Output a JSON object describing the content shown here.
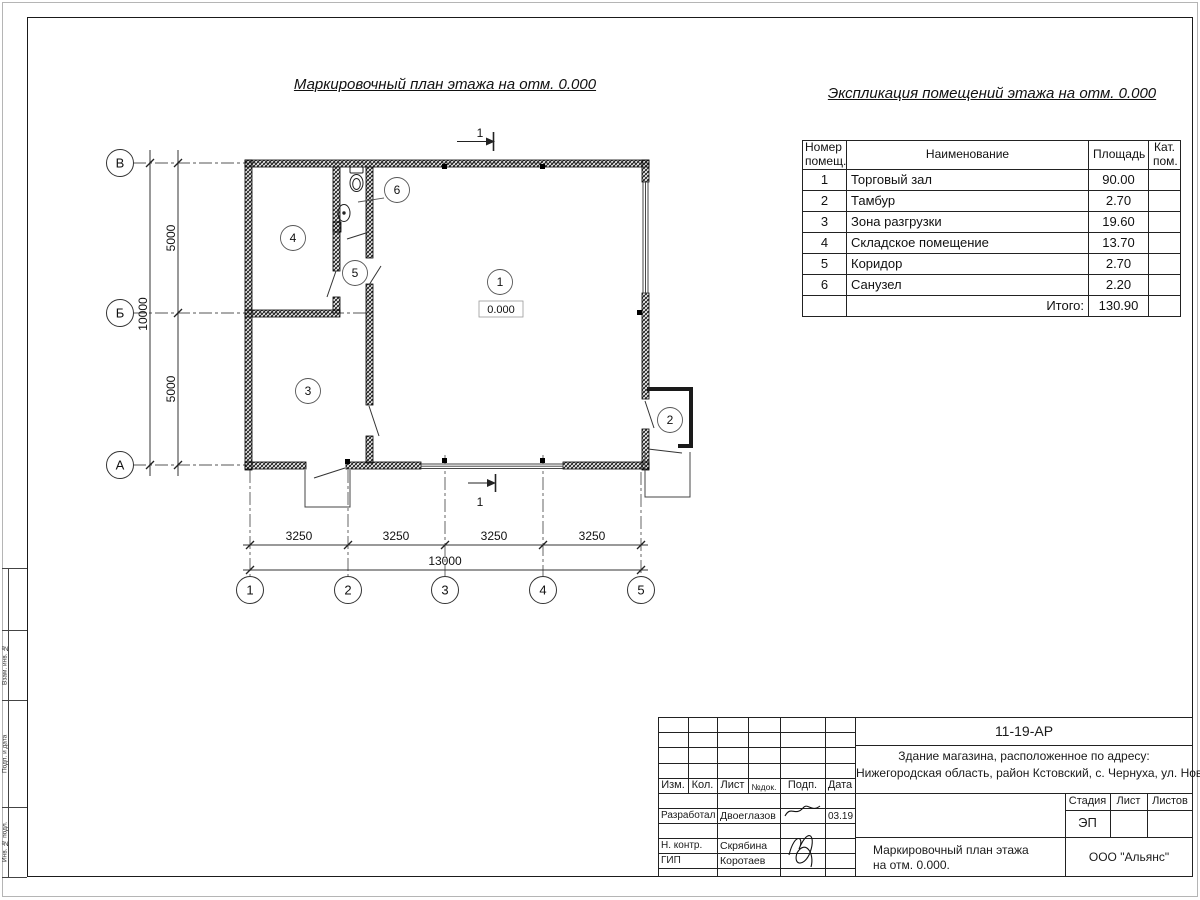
{
  "titles": {
    "plan": "Маркировочный план этажа на отм. 0.000",
    "explication": "Экспликация помещений этажа на отм. 0.000"
  },
  "explication_table": {
    "headers": {
      "number": "Номер помещ.",
      "name": "Наименование",
      "area": "Площадь",
      "category": "Кат. пом."
    },
    "rows": [
      {
        "n": "1",
        "name": "Торговый зал",
        "area": "90.00",
        "cat": ""
      },
      {
        "n": "2",
        "name": "Тамбур",
        "area": "2.70",
        "cat": ""
      },
      {
        "n": "3",
        "name": "Зона разгрузки",
        "area": "19.60",
        "cat": ""
      },
      {
        "n": "4",
        "name": "Складское помещение",
        "area": "13.70",
        "cat": ""
      },
      {
        "n": "5",
        "name": "Коридор",
        "area": "2.70",
        "cat": ""
      },
      {
        "n": "6",
        "name": "Санузел",
        "area": "2.20",
        "cat": ""
      }
    ],
    "total_label": "Итого:",
    "total_area": "130.90"
  },
  "plan": {
    "row_axes": [
      "В",
      "Б",
      "А"
    ],
    "col_axes": [
      "1",
      "2",
      "3",
      "4",
      "5"
    ],
    "dims": {
      "left_upper": "5000",
      "left_lower": "5000",
      "left_total": "10000",
      "bottom_1": "3250",
      "bottom_2": "3250",
      "bottom_3": "3250",
      "bottom_4": "3250",
      "bottom_total": "13000"
    },
    "rooms": {
      "r1": "1",
      "r2": "2",
      "r3": "3",
      "r4": "4",
      "r5": "5",
      "r6": "6"
    },
    "elevation": "0.000",
    "section_mark": "1"
  },
  "title_block": {
    "doc_number": "11-19-АР",
    "object_line1": "Здание магазина, расположенное по адресу:",
    "object_line2": "Нижегородская область, район Кстовский, с. Чернуха, ул. Нов",
    "rev_headers": {
      "izm": "Изм.",
      "kol": "Кол.",
      "list": "Лист",
      "doc": "№док.",
      "sign": "Подп.",
      "date": "Дата"
    },
    "roles": [
      {
        "role": "Разработал",
        "name": "Двоеглазов",
        "date": "03.19"
      },
      {
        "role": "Н. контр.",
        "name": "Скрябина",
        "date": ""
      },
      {
        "role": "ГИП",
        "name": "Коротаев",
        "date": ""
      }
    ],
    "stage_label": "Стадия",
    "sheet_label": "Лист",
    "sheets_label": "Листов",
    "stage_value": "ЭП",
    "drawing_name_line1": "Маркировочный план этажа",
    "drawing_name_line2": "на отм. 0.000.",
    "company": "ООО \"Альянс\""
  },
  "side_stamp": {
    "labels": [
      "Взам. инв. №",
      "Подп. и дата",
      "Инв. № подл."
    ]
  }
}
